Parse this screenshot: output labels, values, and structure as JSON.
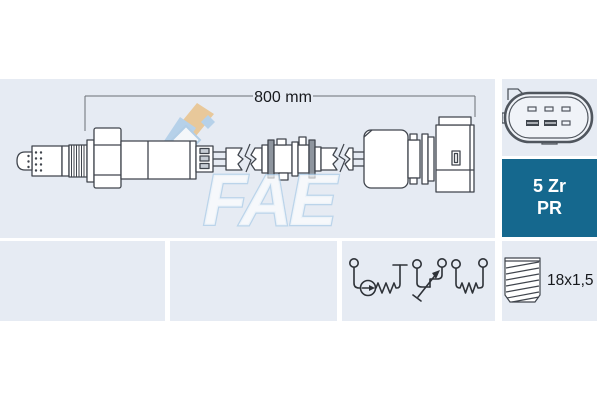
{
  "main_panel": {
    "dimension_label": "800 mm",
    "watermark_text": "FAE"
  },
  "spec_box": {
    "line1": "5 Zr",
    "line2": "PR",
    "bg_color": "#15688e",
    "text_color": "#ffffff"
  },
  "thread_panel": {
    "label": "18x1,5"
  },
  "colors": {
    "panel_bg": "#e6ebf3",
    "drawing_line": "#40454d",
    "schematic_line": "#2e3238",
    "connector_outline": "#50565e",
    "logo_tan": "#e9c28b",
    "logo_blue": "#aecde8"
  }
}
